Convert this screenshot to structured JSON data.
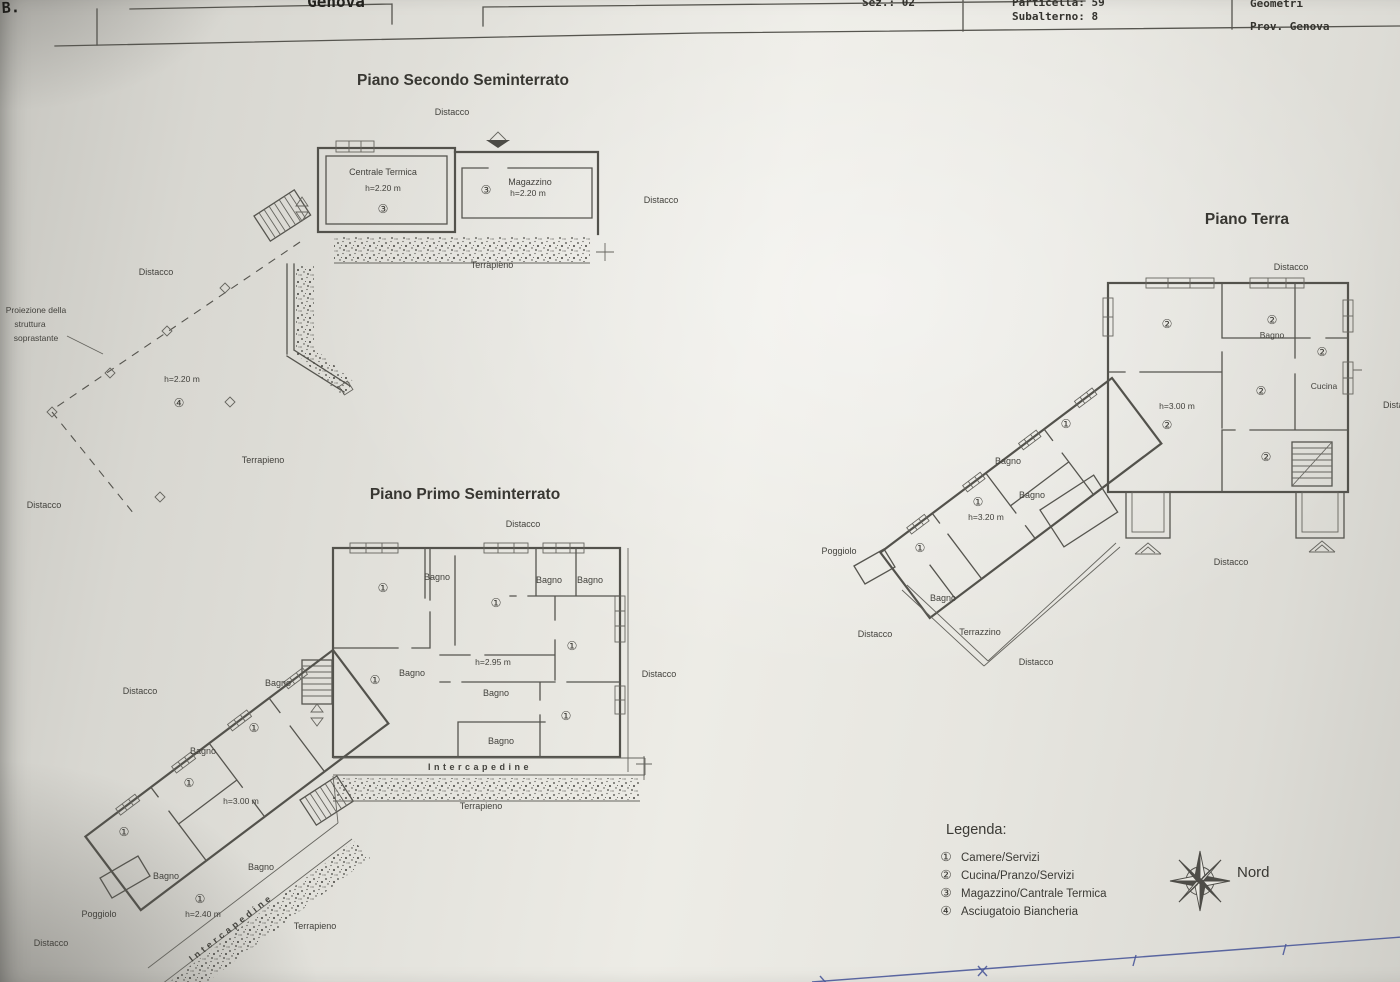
{
  "header": {
    "comune": "Genova",
    "corner_mark": "B.",
    "sez": "Sez.: 02",
    "particella": "Particella: 59",
    "subalterno": "Subalterno: 8",
    "geometri": "Geometri",
    "prov": "Prov. Genova"
  },
  "plan2": {
    "title": "Piano Secondo Seminterrato",
    "labels": {
      "distacco_top": "Distacco",
      "centrale_termica": "Centrale Termica",
      "ct_height": "h=2.20 m",
      "ct_num": "③",
      "mag_num": "③",
      "magazzino": "Magazzino",
      "mag_height": "h=2.20 m",
      "distacco_right": "Distacco",
      "terrapieno_right": "Terrapieno",
      "distacco_left": "Distacco",
      "proiezione_1": "Proiezione della",
      "proiezione_2": "struttura",
      "proiezione_3": "soprastante",
      "height_area": "h=2.20 m",
      "area_num": "④",
      "terrapieno_left": "Terrapieno",
      "distacco_bottom": "Distacco"
    }
  },
  "plan1": {
    "title": "Piano Primo Seminterrato",
    "labels": {
      "distacco_top": "Distacco",
      "num_a": "①",
      "num_b": "①",
      "num_c": "①",
      "num_d": "①",
      "num_e": "①",
      "num_f": "①",
      "num_g": "①",
      "num_h": "①",
      "num_i": "①",
      "bagno_a": "Bagno",
      "bagno_b": "Bagno",
      "bagno_c": "Bagno",
      "bagno_d": "Bagno",
      "bagno_e": "Bagno",
      "bagno_f": "Bagno",
      "bagno_g": "Bagno",
      "bagno_h": "Bagno",
      "bagno_i": "Bagno",
      "bagno_j": "Bagno",
      "h295": "h=2.95 m",
      "h300": "h=3.00 m",
      "h240": "h=2.40 m",
      "intercapedine_h": "Intercapedine",
      "terrapieno_h": "Terrapieno",
      "intercapedine_d": "Intercapedine",
      "terrapieno_d": "Terrapieno",
      "distacco_right": "Distacco",
      "distacco_left": "Distacco",
      "distacco_bottom": "Distacco",
      "poggiolo": "Poggiolo"
    }
  },
  "planT": {
    "title": "Piano Terra",
    "labels": {
      "distacco_top": "Distacco",
      "num2_a": "②",
      "num2_b": "②",
      "num2_c": "②",
      "num2_d": "②",
      "num2_e": "②",
      "num2_f": "②",
      "num1_a": "①",
      "num1_b": "①",
      "num1_c": "①",
      "bagno_a": "Bagno",
      "bagno_b": "Bagno",
      "bagno_c": "Bagno",
      "bagno_d": "Bagno",
      "cucina": "Cucina",
      "h300": "h=3.00 m",
      "h320": "h=3.20 m",
      "poggiolo": "Poggiolo",
      "terrazzino": "Terrazzino",
      "distacco_right": "Distacco",
      "distacco_bl": "Distacco",
      "distacco_b": "Distacco",
      "distacco_bc": "Distacco"
    }
  },
  "legend": {
    "title": "Legenda:",
    "items": [
      {
        "num": "①",
        "label": "Camere/Servizi"
      },
      {
        "num": "②",
        "label": "Cucina/Pranzo/Servizi"
      },
      {
        "num": "③",
        "label": "Magazzino/Cantrale Termica"
      },
      {
        "num": "④",
        "label": "Asciugatoio Biancheria"
      }
    ]
  },
  "compass": {
    "label": "Nord"
  }
}
